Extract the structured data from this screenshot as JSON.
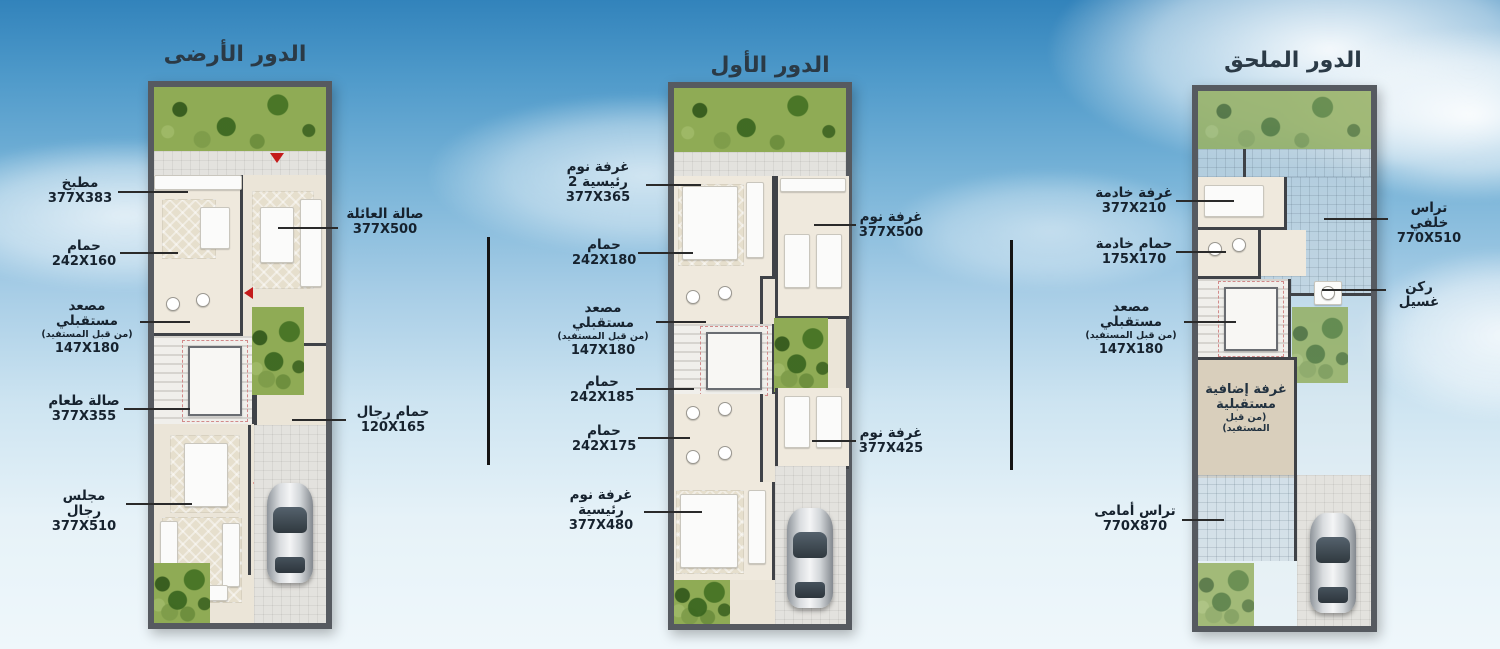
{
  "colors": {
    "sky_top": "#3283bb",
    "sky_bottom": "#eff7fb",
    "plan_border": "#565a60",
    "wall": "#3f4247",
    "floor": "#ebe5d8",
    "garden": "#8fab55",
    "tile": "#e3e2de",
    "label_text": "#16222e",
    "arrow_red": "#c41b1b",
    "future_room": "#d9cfbc"
  },
  "plans": [
    {
      "title": "الدور الأرضى",
      "labels": [
        {
          "text": "مطبخ",
          "dims": "377X383"
        },
        {
          "text": "صالة العائلة",
          "dims": "377X500"
        },
        {
          "text": "حمام",
          "dims": "242X160"
        },
        {
          "text": "مصعد مستقبلي",
          "note": "(من قبل المستفيد)",
          "dims": "147X180"
        },
        {
          "text": "صالة طعام",
          "dims": "377X355"
        },
        {
          "text": "حمام رجال",
          "dims": "120X165"
        },
        {
          "text": "مجلس رجال",
          "dims": "377X510"
        }
      ]
    },
    {
      "title": "الدور الأول",
      "labels": [
        {
          "text": "غرفة نوم رئيسية 2",
          "dims": "377X365"
        },
        {
          "text": "حمام",
          "dims": "242X180"
        },
        {
          "text": "مصعد مستقبلي",
          "note": "(من قبل المستفيد)",
          "dims": "147X180"
        },
        {
          "text": "حمام",
          "dims": "242X185"
        },
        {
          "text": "حمام",
          "dims": "242X175"
        },
        {
          "text": "غرفة نوم رئيسية",
          "dims": "377X480"
        },
        {
          "text": "غرفة نوم",
          "dims": "377X500"
        },
        {
          "text": "غرفة نوم",
          "dims": "377X425"
        }
      ]
    },
    {
      "title": "الدور الملحق",
      "labels": [
        {
          "text": "غرفة خادمة",
          "dims": "377X210"
        },
        {
          "text": "حمام خادمة",
          "dims": "175X170"
        },
        {
          "text": "مصعد مستقبلي",
          "note": "(من قبل المستفيد)",
          "dims": "147X180"
        },
        {
          "text": "تراس أمامى",
          "dims": "770X870"
        },
        {
          "text": "تراس خلفي",
          "dims": "770X510"
        },
        {
          "text": "ركن غسيل"
        }
      ],
      "room_text": {
        "title": "غرفة إضافية مستقبلية",
        "note": "(من قبل المستفيد)"
      }
    }
  ]
}
